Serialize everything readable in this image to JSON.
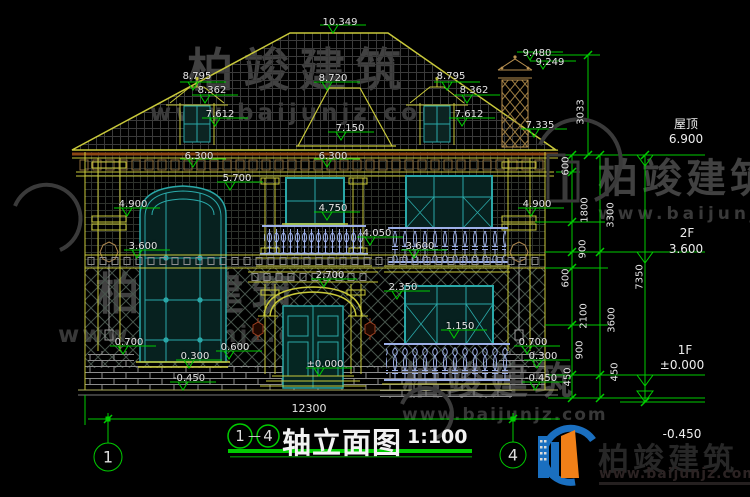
{
  "title": {
    "axis_left": "1",
    "axis_right": "4",
    "dash": "—",
    "name": "轴立面图",
    "scale": "1:100"
  },
  "bottom_dim": {
    "total": "12300"
  },
  "annotations": [
    {
      "label": "10.349"
    },
    {
      "label": "8.795"
    },
    {
      "label": "8.362"
    },
    {
      "label": "7.612"
    },
    {
      "label": "8.720"
    },
    {
      "label": "7.150"
    },
    {
      "label": "8.795"
    },
    {
      "label": "8.362"
    },
    {
      "label": "7.612"
    },
    {
      "label": "9.480"
    },
    {
      "label": "9.249"
    },
    {
      "label": "7.335"
    },
    {
      "label": "6.300"
    },
    {
      "label": "6.300"
    },
    {
      "label": "5.700"
    },
    {
      "label": "4.900"
    },
    {
      "label": "4.900"
    },
    {
      "label": "4.750"
    },
    {
      "label": "4.050"
    },
    {
      "label": "3.600"
    },
    {
      "label": "3.600"
    },
    {
      "label": "2.700"
    },
    {
      "label": "2.350"
    },
    {
      "label": "1.150"
    },
    {
      "label": "0.700"
    },
    {
      "label": "0.600"
    },
    {
      "label": "0.300"
    },
    {
      "label": "-0.450"
    },
    {
      "label": "±0.000"
    },
    {
      "label": "0.700"
    },
    {
      "label": "0.300"
    },
    {
      "label": "-0.450"
    }
  ],
  "right_chain": {
    "upper": "3033",
    "total": "7350",
    "small": [
      "600",
      "1800",
      "900",
      "600",
      "2100",
      "900",
      "450"
    ],
    "story": [
      "3300",
      "3600",
      "450"
    ]
  },
  "floors": [
    {
      "name": "屋顶",
      "elev": "6.900"
    },
    {
      "name": "2F",
      "elev": "3.600"
    },
    {
      "name": "1F",
      "elev": "±0.000"
    },
    {
      "name": "",
      "elev": "-0.450"
    }
  ],
  "brand": {
    "name": "柏竣建筑",
    "url": "www.baijunjz.com"
  },
  "colors": {
    "dim_green": "#00cc00",
    "outline_yellow": "#c9c93a",
    "window_teal": "#2aa8a8",
    "logo_blue": "#1a6fc0",
    "logo_orange": "#f08018"
  }
}
